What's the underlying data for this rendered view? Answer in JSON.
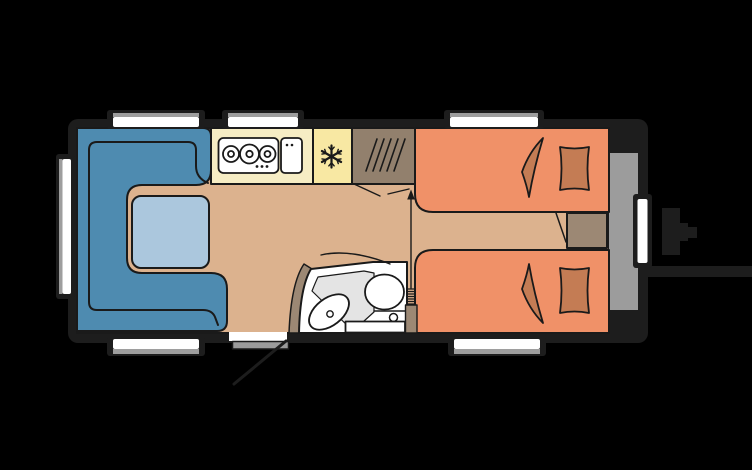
{
  "title": "caravan-floorplan",
  "colors": {
    "background": "#000000",
    "chassis": "#1d1d1d",
    "outline": "#1a1a1a",
    "floor": "#dcb28e",
    "seat": "#4e8bb0",
    "table": "#abc7dd",
    "counter": "#f6edc4",
    "fridge": "#f8e8a3",
    "wardrobe": "#92806d",
    "taupe": "#9c8874",
    "bed": "#f09168",
    "pillow": "#c47c54",
    "front_storage": "#9c9c9c",
    "bath_floor": "#e4e4e4",
    "white": "#ffffff",
    "window_shade": "#9e9e9e",
    "step": "#9b9b9b"
  },
  "icons": {
    "freezer": "snowflake-icon",
    "wardrobe": "hanging-rail-hatch-icon",
    "heater": "heater-coil-icon",
    "door_swing": "door-swing-arc-icon",
    "opening_direction": "arrow-up-icon"
  },
  "counts": {
    "burners": 3,
    "beds": 2,
    "pillows": 2,
    "windows_top": 3,
    "windows_bottom": 2,
    "windows_left": 1,
    "windows_right": 1
  }
}
